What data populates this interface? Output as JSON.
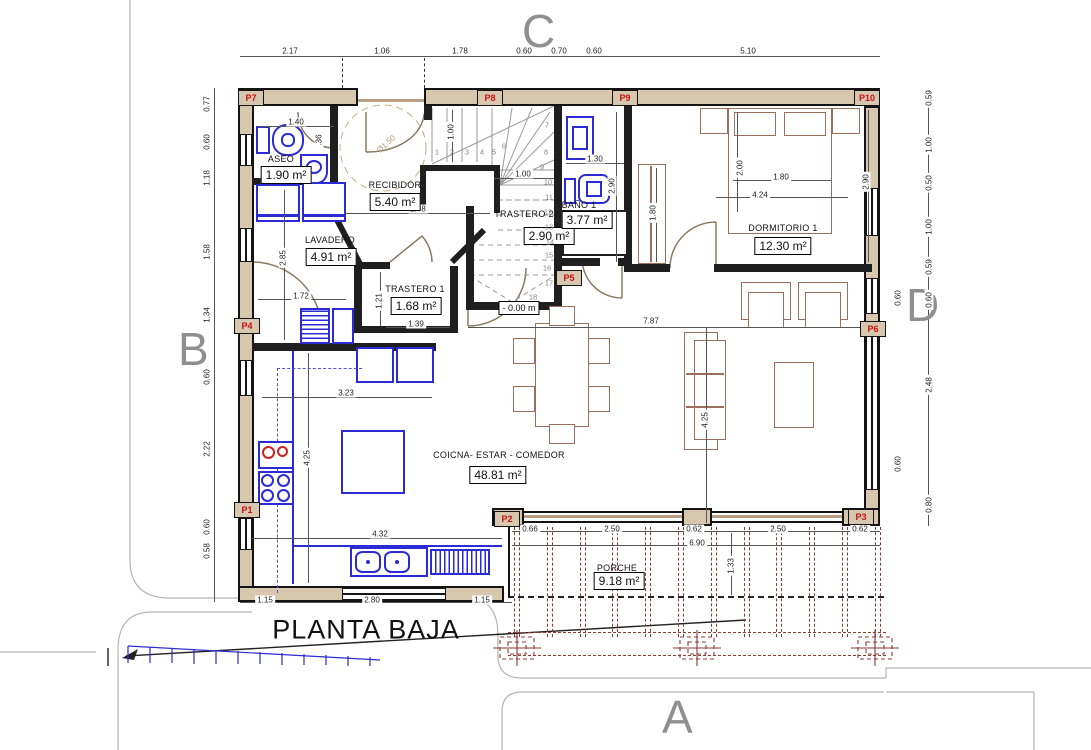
{
  "title": "PLANTA BAJA",
  "grid": {
    "top": "C",
    "left": "B",
    "right": "D",
    "bottom": "A"
  },
  "level": "- 0.00 m",
  "circle_label": "Ø1.50",
  "colors": {
    "wall": "#141414",
    "wall_fill": "#d6c7ae",
    "fixture_blue": "#2b2bd5",
    "furniture_brown": "#9c6f5c",
    "porch_red": "#8c3a32",
    "marker_red": "#cc1111",
    "grid_gray": "#8f8f8f",
    "hob_red": "#cc2222"
  },
  "rooms": [
    {
      "name": "ASEO",
      "area": "1.90 m²",
      "nx": 281,
      "ny": 159,
      "bx": 286,
      "by": 175
    },
    {
      "name": "RECIBIDOR",
      "area": "5.40 m²",
      "nx": 395,
      "ny": 185,
      "bx": 395,
      "by": 202
    },
    {
      "name": "LAVADERO",
      "area": "4.91 m²",
      "nx": 330,
      "ny": 240,
      "bx": 331,
      "by": 257
    },
    {
      "name": "TRASTERO 1",
      "area": "1.68 m²",
      "nx": 415,
      "ny": 289,
      "bx": 416,
      "by": 306
    },
    {
      "name": "TRASTERO 2",
      "area": "2.90 m²",
      "nx": 524,
      "ny": 214,
      "bx": 549,
      "by": 236
    },
    {
      "name": "BAÑO 1",
      "area": "3.77 m²",
      "nx": 579,
      "ny": 205,
      "bx": 587,
      "by": 220
    },
    {
      "name": "DORMITORIO 1",
      "area": "12.30 m²",
      "nx": 783,
      "ny": 228,
      "bx": 783,
      "by": 246
    },
    {
      "name": "COICNA- ESTAR - COMEDOR",
      "area": "48.81 m²",
      "nx": 499,
      "ny": 455,
      "bx": 498,
      "by": 475
    },
    {
      "name": "PORCHE",
      "area": "9.18 m²",
      "nx": 617,
      "ny": 568,
      "bx": 619,
      "by": 581
    }
  ],
  "markers": [
    {
      "id": "P1",
      "x": 234,
      "y": 502
    },
    {
      "id": "P2",
      "x": 494,
      "y": 511
    },
    {
      "id": "P3",
      "x": 848,
      "y": 509
    },
    {
      "id": "P4",
      "x": 234,
      "y": 318
    },
    {
      "id": "P5",
      "x": 556,
      "y": 270
    },
    {
      "id": "P6",
      "x": 860,
      "y": 321
    },
    {
      "id": "P7",
      "x": 238,
      "y": 90
    },
    {
      "id": "P8",
      "x": 477,
      "y": 90
    },
    {
      "id": "P9",
      "x": 612,
      "y": 90
    },
    {
      "id": "P10",
      "x": 854,
      "y": 90
    }
  ],
  "stair_numbers": [
    {
      "n": "1",
      "x": 437,
      "y": 152
    },
    {
      "n": "2",
      "x": 452,
      "y": 152
    },
    {
      "n": "3",
      "x": 467,
      "y": 152
    },
    {
      "n": "4",
      "x": 482,
      "y": 152
    },
    {
      "n": "5",
      "x": 494,
      "y": 152
    },
    {
      "n": "6",
      "x": 504,
      "y": 146
    },
    {
      "n": "7",
      "x": 547,
      "y": 125
    },
    {
      "n": "8",
      "x": 546,
      "y": 152
    },
    {
      "n": "9",
      "x": 542,
      "y": 167
    },
    {
      "n": "10",
      "x": 548,
      "y": 182
    },
    {
      "n": "11",
      "x": 549,
      "y": 197
    },
    {
      "n": "12",
      "x": 548,
      "y": 212
    },
    {
      "n": "13",
      "x": 549,
      "y": 227
    },
    {
      "n": "14",
      "x": 550,
      "y": 242
    },
    {
      "n": "15",
      "x": 549,
      "y": 255
    },
    {
      "n": "16",
      "x": 547,
      "y": 268
    },
    {
      "n": "17",
      "x": 549,
      "y": 283
    },
    {
      "n": "18",
      "x": 533,
      "y": 297
    }
  ],
  "dims": [
    {
      "v": "2.17",
      "x": 290,
      "y": 51
    },
    {
      "v": "1.06",
      "x": 382,
      "y": 51
    },
    {
      "v": "1.78",
      "x": 460,
      "y": 51
    },
    {
      "v": "0.60",
      "x": 524,
      "y": 51
    },
    {
      "v": "0.70",
      "x": 559,
      "y": 51
    },
    {
      "v": "0.60",
      "x": 594,
      "y": 51
    },
    {
      "v": "5.10",
      "x": 748,
      "y": 51
    },
    {
      "v": "0.77",
      "x": 207,
      "y": 104,
      "r": 1
    },
    {
      "v": "0.60",
      "x": 207,
      "y": 142,
      "r": 1
    },
    {
      "v": "1.18",
      "x": 207,
      "y": 178,
      "r": 1
    },
    {
      "v": "1.58",
      "x": 207,
      "y": 252,
      "r": 1
    },
    {
      "v": "1.34",
      "x": 207,
      "y": 315,
      "r": 1
    },
    {
      "v": "0.60",
      "x": 207,
      "y": 377,
      "r": 1
    },
    {
      "v": "2.22",
      "x": 207,
      "y": 449,
      "r": 1
    },
    {
      "v": "0.60",
      "x": 207,
      "y": 527,
      "r": 1
    },
    {
      "v": "0.58",
      "x": 207,
      "y": 551,
      "r": 1
    },
    {
      "v": "0.59",
      "x": 929,
      "y": 98,
      "r": 1
    },
    {
      "v": "1.00",
      "x": 929,
      "y": 145,
      "r": 1
    },
    {
      "v": "0.50",
      "x": 929,
      "y": 183,
      "r": 1
    },
    {
      "v": "1.00",
      "x": 929,
      "y": 227,
      "r": 1
    },
    {
      "v": "0.59",
      "x": 929,
      "y": 267,
      "r": 1
    },
    {
      "v": "0.60",
      "x": 929,
      "y": 300,
      "r": 1
    },
    {
      "v": "2.48",
      "x": 929,
      "y": 385,
      "r": 1
    },
    {
      "v": "0.80",
      "x": 929,
      "y": 505,
      "r": 1
    },
    {
      "v": "1.15",
      "x": 265,
      "y": 600
    },
    {
      "v": "2.80",
      "x": 372,
      "y": 600
    },
    {
      "v": "1.15",
      "x": 482,
      "y": 600
    },
    {
      "v": "0.66",
      "x": 530,
      "y": 529
    },
    {
      "v": "2.50",
      "x": 612,
      "y": 529
    },
    {
      "v": "0.62",
      "x": 694,
      "y": 529
    },
    {
      "v": "2.50",
      "x": 778,
      "y": 529
    },
    {
      "v": "0.62",
      "x": 860,
      "y": 529
    },
    {
      "v": "6.90",
      "x": 697,
      "y": 543
    },
    {
      "v": "1.33",
      "x": 731,
      "y": 566,
      "r": 1
    },
    {
      "v": "1.40",
      "x": 296,
      "y": 122
    },
    {
      "v": ".36",
      "x": 319,
      "y": 140,
      "r": 1
    },
    {
      "v": "2.85",
      "x": 283,
      "y": 258,
      "r": 1
    },
    {
      "v": "1.72",
      "x": 301,
      "y": 296
    },
    {
      "v": "1.21",
      "x": 379,
      "y": 301,
      "r": 1
    },
    {
      "v": "1.39",
      "x": 416,
      "y": 324
    },
    {
      "v": "2.48",
      "x": 418,
      "y": 209
    },
    {
      "v": "1.00",
      "x": 451,
      "y": 132,
      "r": 1
    },
    {
      "v": "1.00",
      "x": 523,
      "y": 174
    },
    {
      "v": "3.23",
      "x": 346,
      "y": 393
    },
    {
      "v": "4.25",
      "x": 307,
      "y": 458,
      "r": 1
    },
    {
      "v": "4.32",
      "x": 380,
      "y": 534
    },
    {
      "v": "1.30",
      "x": 595,
      "y": 159
    },
    {
      "v": "2.90",
      "x": 612,
      "y": 186,
      "r": 1
    },
    {
      "v": "1.80",
      "x": 653,
      "y": 213,
      "r": 1
    },
    {
      "v": "2.00",
      "x": 740,
      "y": 168,
      "r": 1
    },
    {
      "v": "1.80",
      "x": 781,
      "y": 177
    },
    {
      "v": "4.24",
      "x": 760,
      "y": 195
    },
    {
      "v": "2.90",
      "x": 866,
      "y": 182,
      "r": 1
    },
    {
      "v": "7.87",
      "x": 651,
      "y": 321
    },
    {
      "v": "4.25",
      "x": 705,
      "y": 420,
      "r": 1
    },
    {
      "v": "0.60",
      "x": 898,
      "y": 298,
      "r": 1
    },
    {
      "v": "0.60",
      "x": 898,
      "y": 464,
      "r": 1
    }
  ]
}
